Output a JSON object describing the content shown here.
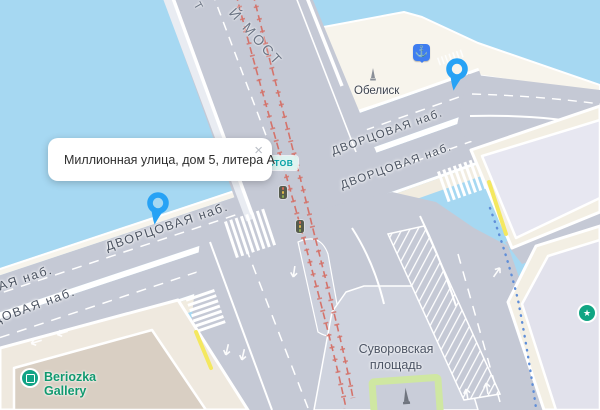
{
  "app": "map-view",
  "popup": {
    "address": "Миллионная улица, дом 5, литера А",
    "close_glyph": "×"
  },
  "streets": {
    "embankment_label": "ДВОРЦОВАЯ наб."
  },
  "bridge": {
    "label_fragment": "Й МОСТ",
    "label_fragment_2": "Т"
  },
  "squares": {
    "suvorovskaya": {
      "line1": "Суворовская",
      "line2": "площадь"
    }
  },
  "pois": {
    "obelisk": "Обелиск",
    "beriozka": {
      "line1": "Beriozka",
      "line2": "Gallery"
    }
  },
  "transit": {
    "stop_label_fragment": "мостов"
  },
  "icons": {
    "anchor_glyph": "⚓",
    "star_glyph": "★"
  },
  "colors": {
    "water": "#a6d8f2",
    "road": "#c5c9d5",
    "island": "#cfd3de",
    "quay": "#f7f4ec",
    "building_lavender": "#e7e7f1",
    "building_beige": "#d9cfc3",
    "sidewalk": "#f3efe4",
    "pin_blue": "#27a2f5",
    "poi_green": "#10a583",
    "tram_red": "#d4736b",
    "route_blue": "#5f8ed8",
    "curb_yellow": "#f4e860",
    "park_green": "#cfe7a2"
  }
}
